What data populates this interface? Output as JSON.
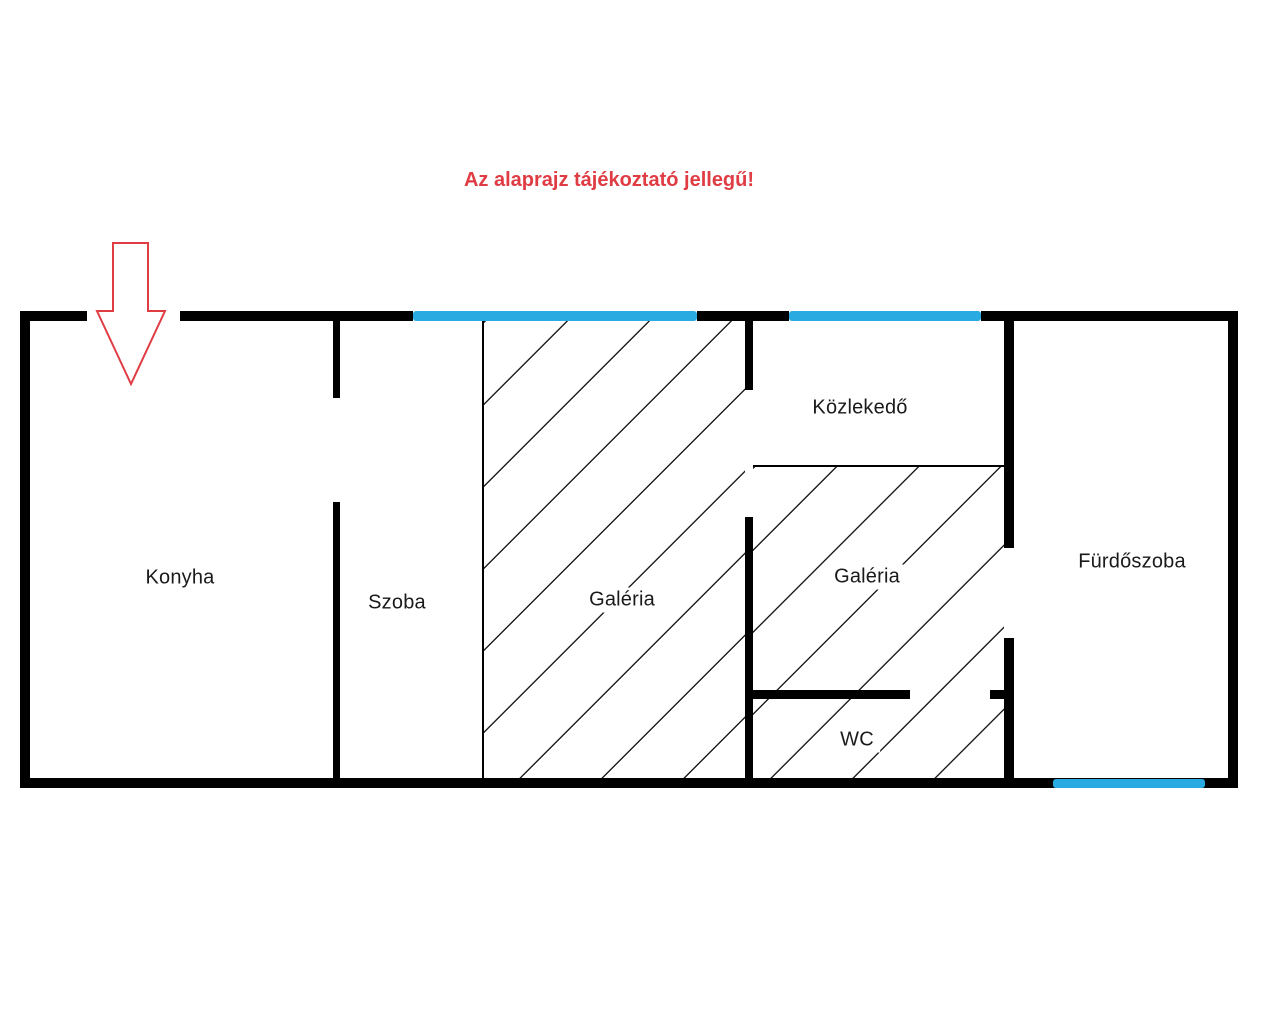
{
  "title": "Az alaprajz tájékoztató jellegű!",
  "rooms": {
    "konyha": {
      "label": "Konyha"
    },
    "szoba": {
      "label": "Szoba"
    },
    "galeria_left": {
      "label": "Galéria"
    },
    "kozlekedo": {
      "label": "Közlekedő"
    },
    "galeria_right": {
      "label": "Galéria"
    },
    "wc": {
      "label": "WC"
    },
    "furdoszoba": {
      "label": "Fürdőszoba"
    }
  },
  "colors": {
    "wall": "#000000",
    "window_blue": "#29abe2",
    "annotation_red": "#e03c44",
    "label": "#1a1a1a",
    "background": "#ffffff"
  },
  "icons": {
    "entrance_arrow": "down-arrow-outline"
  }
}
